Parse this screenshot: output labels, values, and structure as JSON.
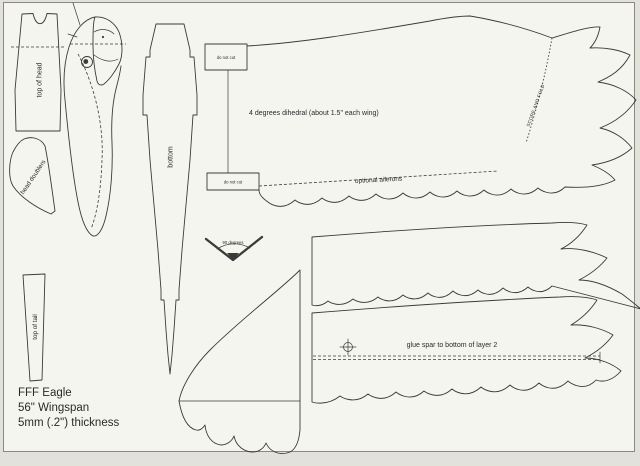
{
  "colors": {
    "line": "#3a3a3a",
    "text": "#2a2a2a",
    "page_bg": "#f5f5ef",
    "margin_bg": "#e2e2da",
    "border": "#8a8a82"
  },
  "title_block": [
    "FFF Eagle",
    "56\" Wingspan",
    "5mm (.2\") thickness"
  ],
  "labels": {
    "top_of_head": "top of head",
    "head_doublers": "head doublers",
    "top_of_tail": "top of tail",
    "bottom": "bottom",
    "do_not_cut_top": "do not cut",
    "do_not_cut_bottom": "do not cut",
    "dihedral_note": "4 degrees dihedral (about 1.5\" each wing)",
    "optional_ailerons": "optional ailerons",
    "score_and_fold": "SCORE AND FOLD",
    "gauge_degrees": "90 degrees",
    "glue_spar": "glue spar to bottom of layer 2"
  }
}
